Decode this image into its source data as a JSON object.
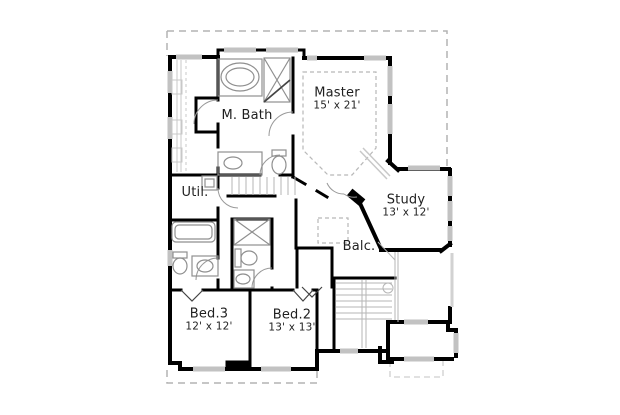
{
  "palette": {
    "wall": "#000000",
    "window": "#c2c2c2",
    "window_light": "#d2d2d2",
    "fixture": "#8f8f8f",
    "stair": "#b5b5b5",
    "closet": "#c8c8c8",
    "roof_dash": "#b3b3b3",
    "roof_dash_light": "#cfcfcf",
    "ceiling_dash": "#b8b8b8",
    "door_arc": "#999999",
    "door_mark": "#444444",
    "text": "#1f1f1f",
    "background": "#ffffff"
  },
  "rooms": {
    "master": {
      "name": "Master",
      "dims": "15' x 21'"
    },
    "mbath": {
      "name": "M. Bath"
    },
    "study": {
      "name": "Study",
      "dims": "13' x 12'"
    },
    "balcony": {
      "name": "Balc."
    },
    "utility": {
      "name": "Util."
    },
    "bed3": {
      "name": "Bed.3",
      "dims": "12' x 12'"
    },
    "bed2": {
      "name": "Bed.2",
      "dims": "13' x 13'"
    }
  },
  "fixture_icons": [
    "garden-tub-icon",
    "corner-shower-icon",
    "vanity-sink-icon",
    "toilet-icon",
    "washer-icon",
    "bathtub-icon",
    "shower-icon",
    "staircase-icon",
    "balcony-opening-icon",
    "closet-rod-icon"
  ]
}
